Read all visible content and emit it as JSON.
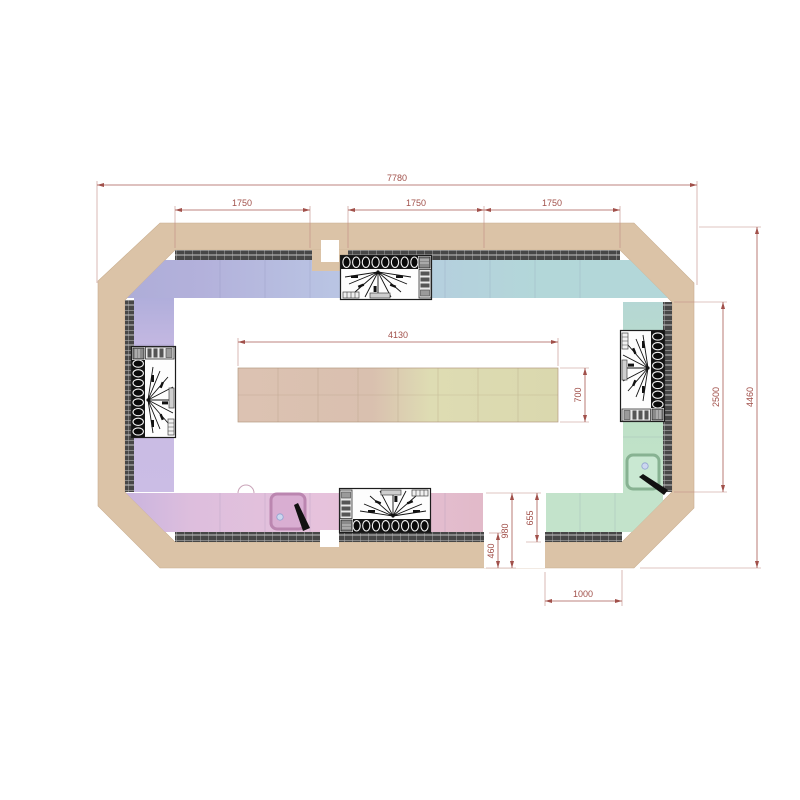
{
  "drawing": {
    "type": "kitchen-floor-plan",
    "dims": {
      "overall_width": "7780",
      "seg_left": "1750",
      "seg_mid": "1750",
      "seg_right": "1750",
      "island_length": "4130",
      "island_depth": "700",
      "right_wall_opening": "2500",
      "overall_depth": "4460",
      "corner_return": "655",
      "opening_depth": "980",
      "wall_gap": "460",
      "corner_counter_width": "1000"
    },
    "colors": {
      "wall": "#dbc3a7",
      "tile_strip": "#474747",
      "counter_periwinkle": "#aeadd8",
      "counter_blue": "#b9c4e3",
      "counter_teal": "#b3d7d9",
      "counter_lavender": "#cbbde5",
      "counter_green": "#c2e3ca",
      "counter_pink": "#e6c2dc",
      "counter_rose": "#e2bac9",
      "island_left": "#dcc2b2",
      "island_right": "#dad8ae",
      "dimension": "#a1504a"
    },
    "appliances": [
      {
        "name": "range-cooker-top"
      },
      {
        "name": "range-cooker-left"
      },
      {
        "name": "range-cooker-right"
      },
      {
        "name": "range-cooker-bottom"
      },
      {
        "name": "sink-bottom-left"
      },
      {
        "name": "sink-right"
      }
    ]
  }
}
